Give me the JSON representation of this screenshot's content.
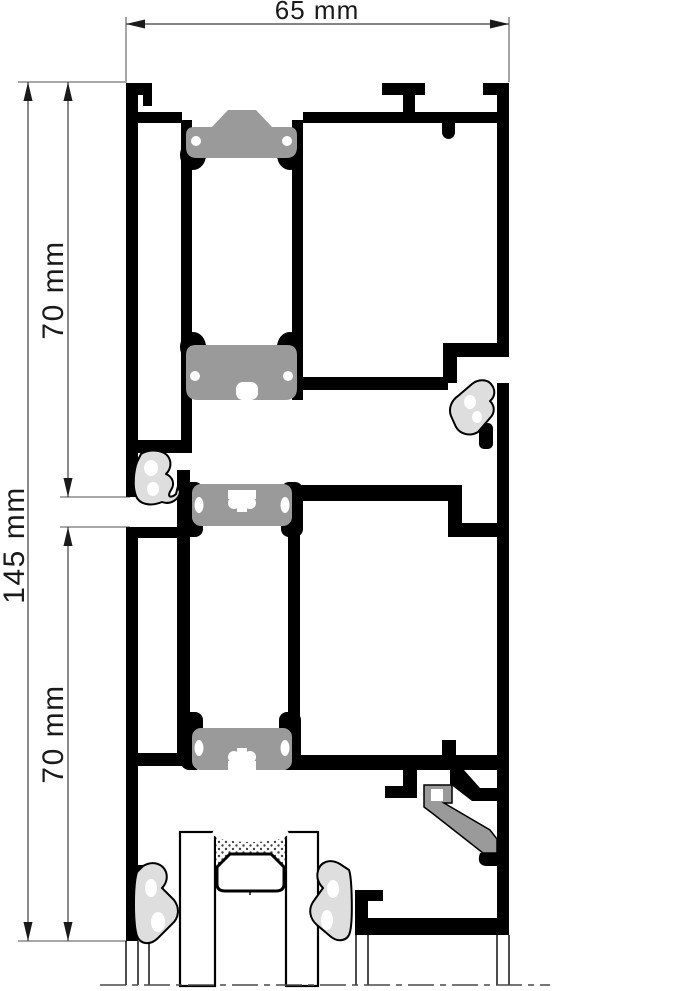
{
  "dimensions": {
    "overall_width": {
      "label": "65 mm"
    },
    "overall_height": {
      "label": "145 mm"
    },
    "upper_profile_height": {
      "label": "70 mm"
    },
    "lower_profile_height": {
      "label": "70 mm"
    }
  },
  "colors": {
    "aluminum": "#000000",
    "thermal_break": "#9a9a9a",
    "glazing_support": "#9a9a9a",
    "gasket": "#dedede",
    "dimension_line": "#3c3c3c",
    "extension_line": "#9b9b9b",
    "label_text": "#1a1a1a",
    "background": "#ffffff"
  }
}
